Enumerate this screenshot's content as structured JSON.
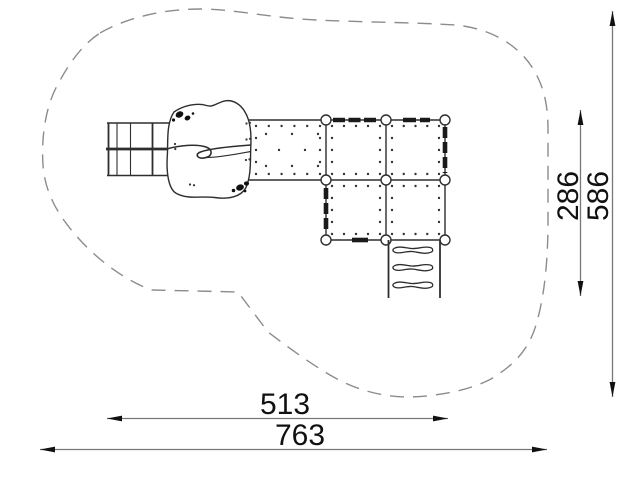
{
  "drawing": {
    "type": "playground-equipment-plan-top-view",
    "dimensions": {
      "width_inner": "513",
      "width_outer": "763",
      "height_inner": "286",
      "height_outer": "586"
    },
    "colors": {
      "background": "#ffffff",
      "structure_outline": "#2e2e2e",
      "safety_zone_boundary": "#8c8c8c",
      "dimension_line": "#787878",
      "dimension_text": "#111111",
      "railing": "#1a1a1a"
    }
  }
}
